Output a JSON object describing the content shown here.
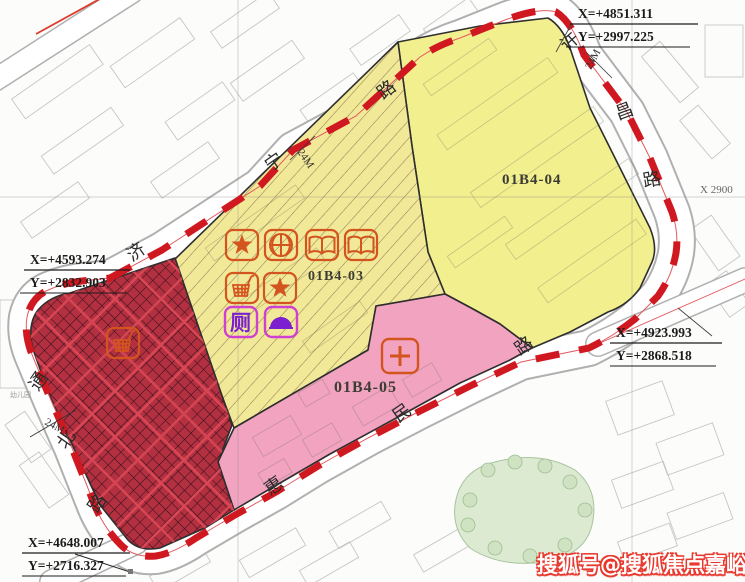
{
  "parcels": [
    {
      "id": "01B4-03",
      "fill": "hatched-yellow"
    },
    {
      "id": "01B4-04",
      "fill": "yellow"
    },
    {
      "id": "01B4-05",
      "fill": "pink"
    }
  ],
  "unlabeled_zone": {
    "fill": "dark-red-crosshatch"
  },
  "roads": {
    "jining": {
      "name": "济宁路",
      "chars": [
        "济",
        "宁",
        "路"
      ]
    },
    "tongbei": {
      "name": "通北路",
      "chars": [
        "通",
        "北",
        "路"
      ]
    },
    "xuchang": {
      "name": "许昌路",
      "chars": [
        "许",
        "昌",
        "路"
      ]
    },
    "huimin": {
      "name": "惠民路",
      "chars": [
        "惠",
        "民",
        "路"
      ]
    }
  },
  "coordinates": {
    "top_right": {
      "x": "X=+4851.311",
      "y": "Y=+2997.225"
    },
    "west": {
      "x": "X=+4593.274",
      "y": "Y=+2832.903"
    },
    "east": {
      "x": "X=+4923.993",
      "y": "Y=+2868.518"
    },
    "south_west": {
      "x": "X=+4648.007",
      "y": "Y=+2716.327"
    }
  },
  "annotations": {
    "road_width": "24M",
    "grid_label": "X 2900",
    "kindergarten_label": "幼儿园"
  },
  "icons": {
    "toilet_char": "厕",
    "items": [
      "star-icon",
      "basketball-icon",
      "book-icon",
      "book-icon",
      "shopping-cart-icon",
      "star-icon",
      "toilet-icon",
      "dome-icon",
      "shopping-cart-icon",
      "clinic-cross-icon"
    ]
  },
  "watermark": {
    "text": "搜狐号@搜狐焦点嘉峪关站"
  },
  "colors": {
    "boundary": "#d01820",
    "road_thin_line": "#e3595f",
    "parcel_yellow": "#f2ef8f",
    "hatch_line": "#8f7f55",
    "parcel_pink": "#f2a3c0",
    "parcel_dark_red": "#b23040",
    "dark_red_hatch": "#35101c",
    "icon_orange": "#d4541f",
    "icon_magenta": "#cf3fd2",
    "icon_purple": "#7b1fd0",
    "watermark_red": "#e8392e"
  }
}
